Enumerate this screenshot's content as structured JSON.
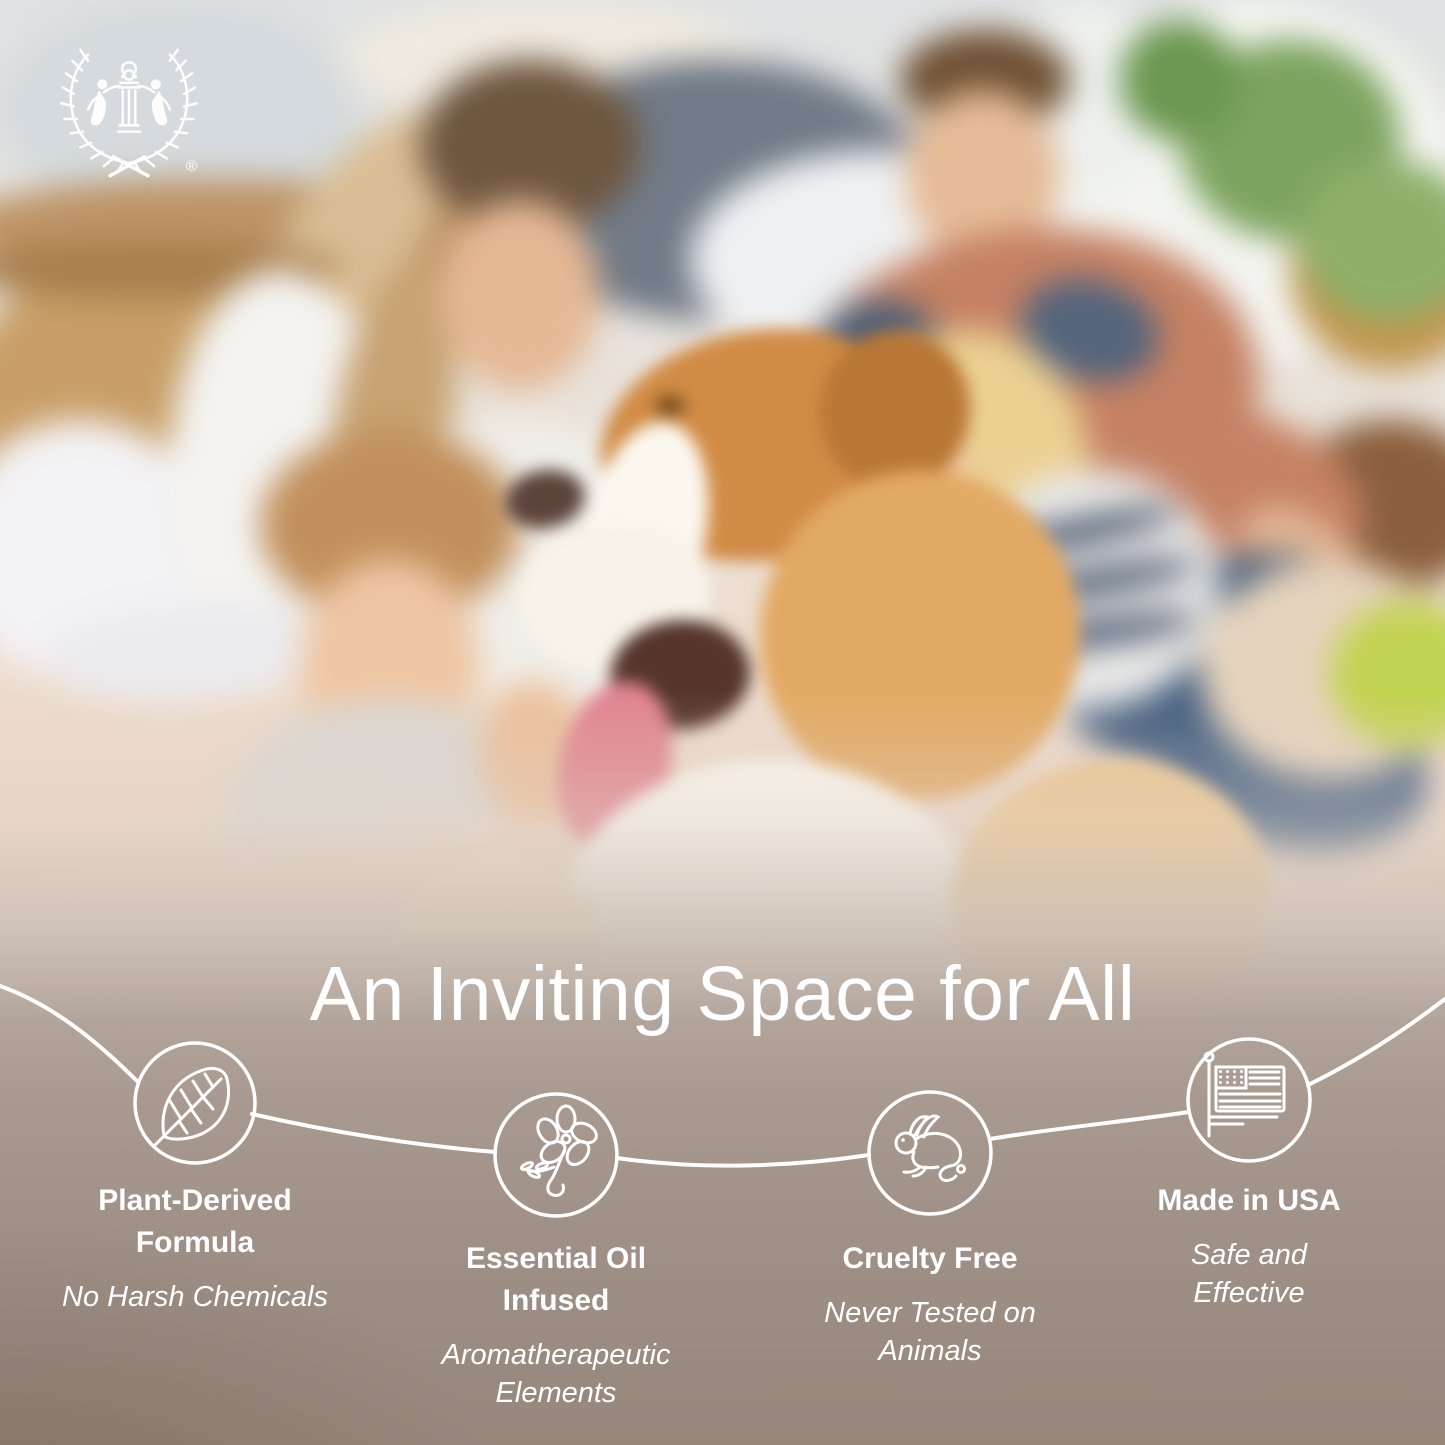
{
  "brand": {
    "logo": "laurel-wreath-with-two-figures-and-column",
    "registered_mark": "®"
  },
  "headline": "An Inviting Space for All",
  "features": [
    {
      "icon": "leaf",
      "title": "Plant-Derived Formula",
      "subtitle": "No Harsh Chemicals"
    },
    {
      "icon": "flower",
      "title": "Essential Oil Infused",
      "subtitle": "Aromatherapeutic Elements"
    },
    {
      "icon": "rabbit",
      "title": "Cruelty Free",
      "subtitle": "Never Tested on Animals"
    },
    {
      "icon": "usa-flag",
      "title": "Made in USA",
      "subtitle": "Safe and Effective"
    }
  ],
  "scene": {
    "description": "Blurred photo of a family of four sitting with a happy tan-and-white border collie dog among cardboard moving boxes in a bright living room"
  },
  "colors": {
    "text": "#ffffff",
    "line_art": "#ffffff",
    "band_top": "#b7aaa1",
    "band_bottom": "#92847a"
  }
}
